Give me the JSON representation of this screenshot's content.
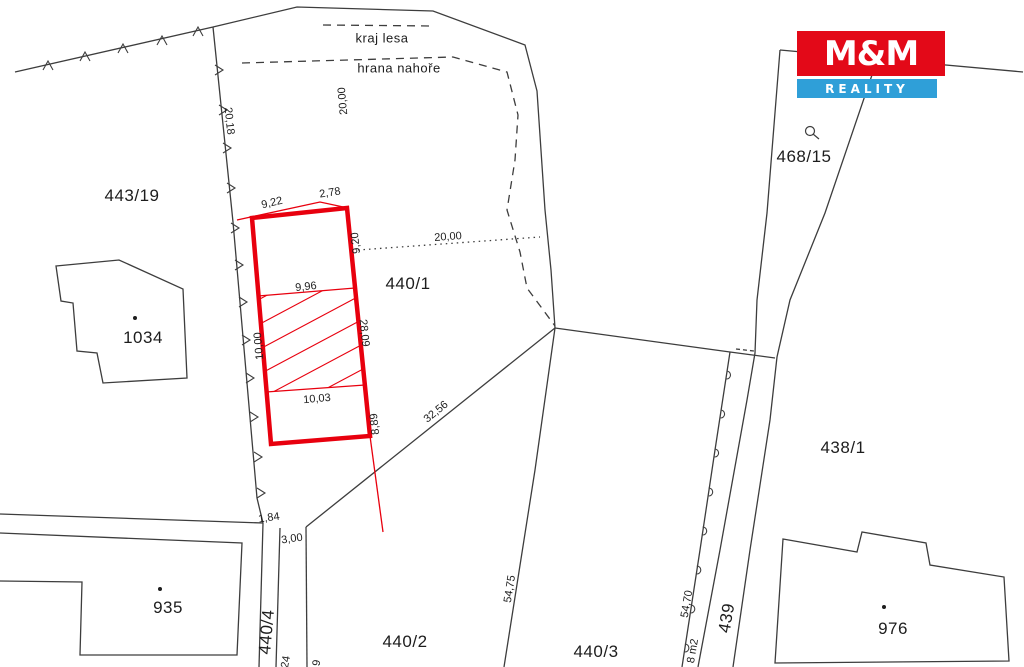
{
  "logo": {
    "title": "M&M",
    "subtitle": "REALITY"
  },
  "annotations": {
    "forest_edge": "kraj lesa",
    "top_edge": "hrana nahoře"
  },
  "parcels": [
    {
      "text": "443/19"
    },
    {
      "text": "1034"
    },
    {
      "text": "935"
    },
    {
      "text": "440/4"
    },
    {
      "text": "440/2"
    },
    {
      "text": "440/3"
    },
    {
      "text": "440/1"
    },
    {
      "text": "468/15"
    },
    {
      "text": "438/1"
    },
    {
      "text": "976"
    },
    {
      "text": "439"
    }
  ],
  "measurements": [
    {
      "text": "20,18"
    },
    {
      "text": "9,22"
    },
    {
      "text": "2,78"
    },
    {
      "text": "20,00"
    },
    {
      "text": "20,00"
    },
    {
      "text": "9,20"
    },
    {
      "text": "9,96"
    },
    {
      "text": "10,00"
    },
    {
      "text": "28,09"
    },
    {
      "text": "10,03"
    },
    {
      "text": "8,89"
    },
    {
      "text": "32,56"
    },
    {
      "text": "1,84"
    },
    {
      "text": "3,00"
    },
    {
      "text": "54,75"
    },
    {
      "text": "54,70"
    },
    {
      "text": "8 m2"
    },
    {
      "text": "24"
    },
    {
      "text": "9"
    }
  ],
  "colors": {
    "highlight_red": "#e8000e",
    "line": "#3d3d3d",
    "logo_red": "#e30918",
    "logo_blue": "#2f9fd8"
  }
}
